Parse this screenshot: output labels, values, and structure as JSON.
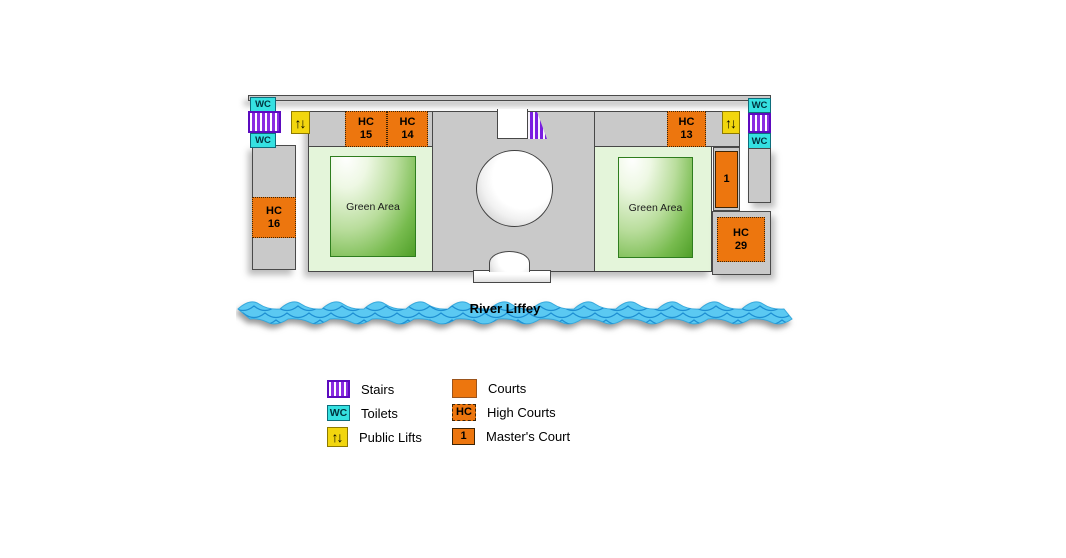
{
  "map": {
    "river_label": "River Liffey",
    "green_area_label": "Green Area",
    "wc_label": "WC",
    "lift_glyph": "↑↓",
    "courts": {
      "hc15": {
        "line1": "HC",
        "line2": "15"
      },
      "hc14": {
        "line1": "HC",
        "line2": "14"
      },
      "hc13": {
        "line1": "HC",
        "line2": "13"
      },
      "hc16": {
        "line1": "HC",
        "line2": "16"
      },
      "hc29": {
        "line1": "HC",
        "line2": "29"
      },
      "masters": {
        "line1": "1"
      }
    }
  },
  "legend": {
    "stairs": "Stairs",
    "toilets": "Toilets",
    "lifts": "Public Lifts",
    "courts": "Courts",
    "high_courts": "High Courts",
    "high_courts_badge": "HC",
    "masters": "Master's Court",
    "masters_badge": "1"
  },
  "colors": {
    "court_orange": "#ed760e",
    "toilet_cyan": "#35e1e1",
    "stairs_purple": "#8a2be2",
    "lift_yellow": "#f2d60e",
    "river_blue": "#5bc9f2",
    "wave_line_blue": "#1e8fd2",
    "green_area_dark": "#4f9f28",
    "building_light_green": "#e4f5da",
    "floor_gray": "#c9c9c9"
  }
}
